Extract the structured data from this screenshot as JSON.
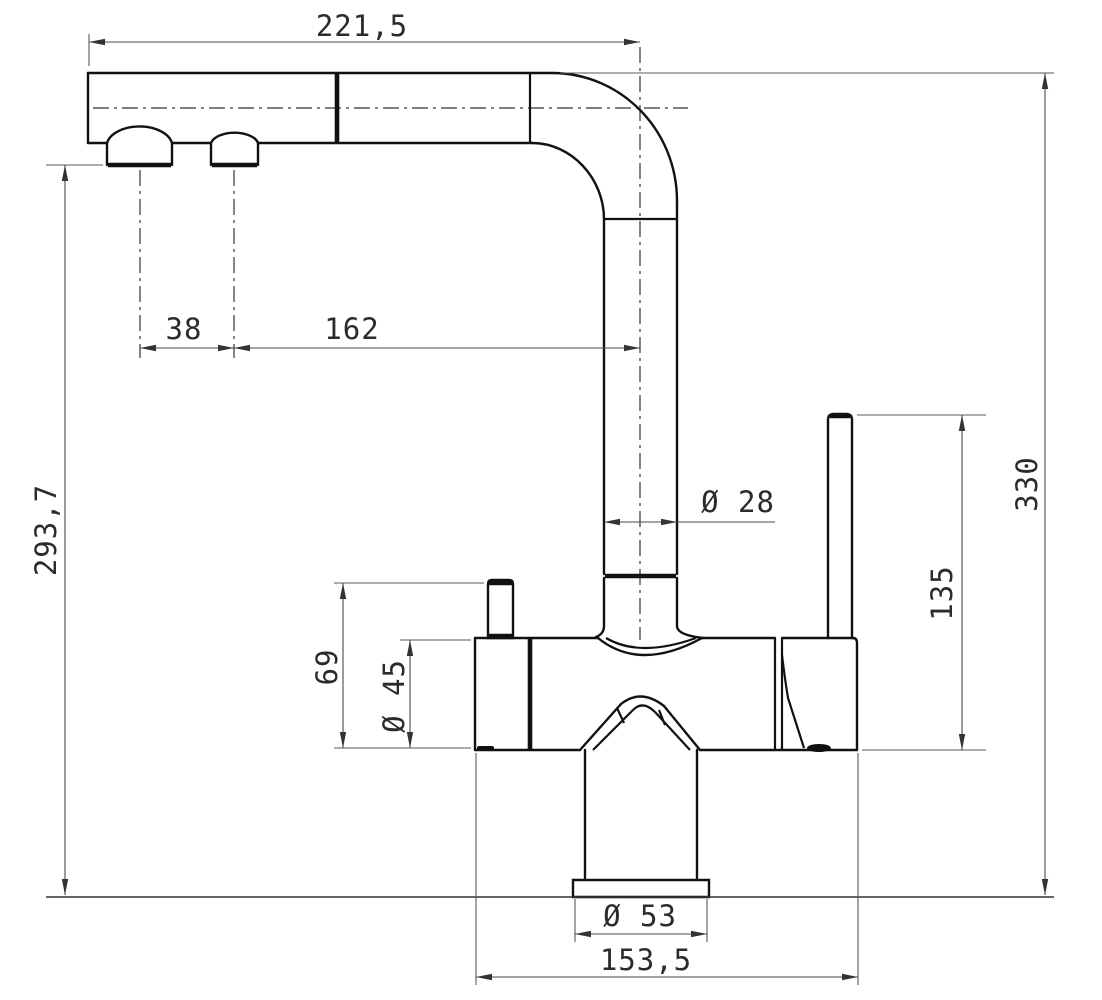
{
  "drawing": {
    "type": "technical-dimension-drawing",
    "subject": "single-lever kitchen mixer faucet, side elevation",
    "units": "mm",
    "colors": {
      "object_line": "#111111",
      "dimension_line": "#4a4a4a",
      "background": "#ffffff"
    },
    "dimensions": {
      "spout_reach": "221,5",
      "aerator_spacing": "38",
      "aerator_to_spout_axis": "162",
      "spout_underside_height": "293,7",
      "total_height": "330",
      "spout_tube_diameter": "Ø 28",
      "lever_height": "135",
      "side_port_height": "69",
      "body_diameter": "Ø 45",
      "base_flange_diameter": "Ø 53",
      "body_length": "153,5"
    }
  }
}
